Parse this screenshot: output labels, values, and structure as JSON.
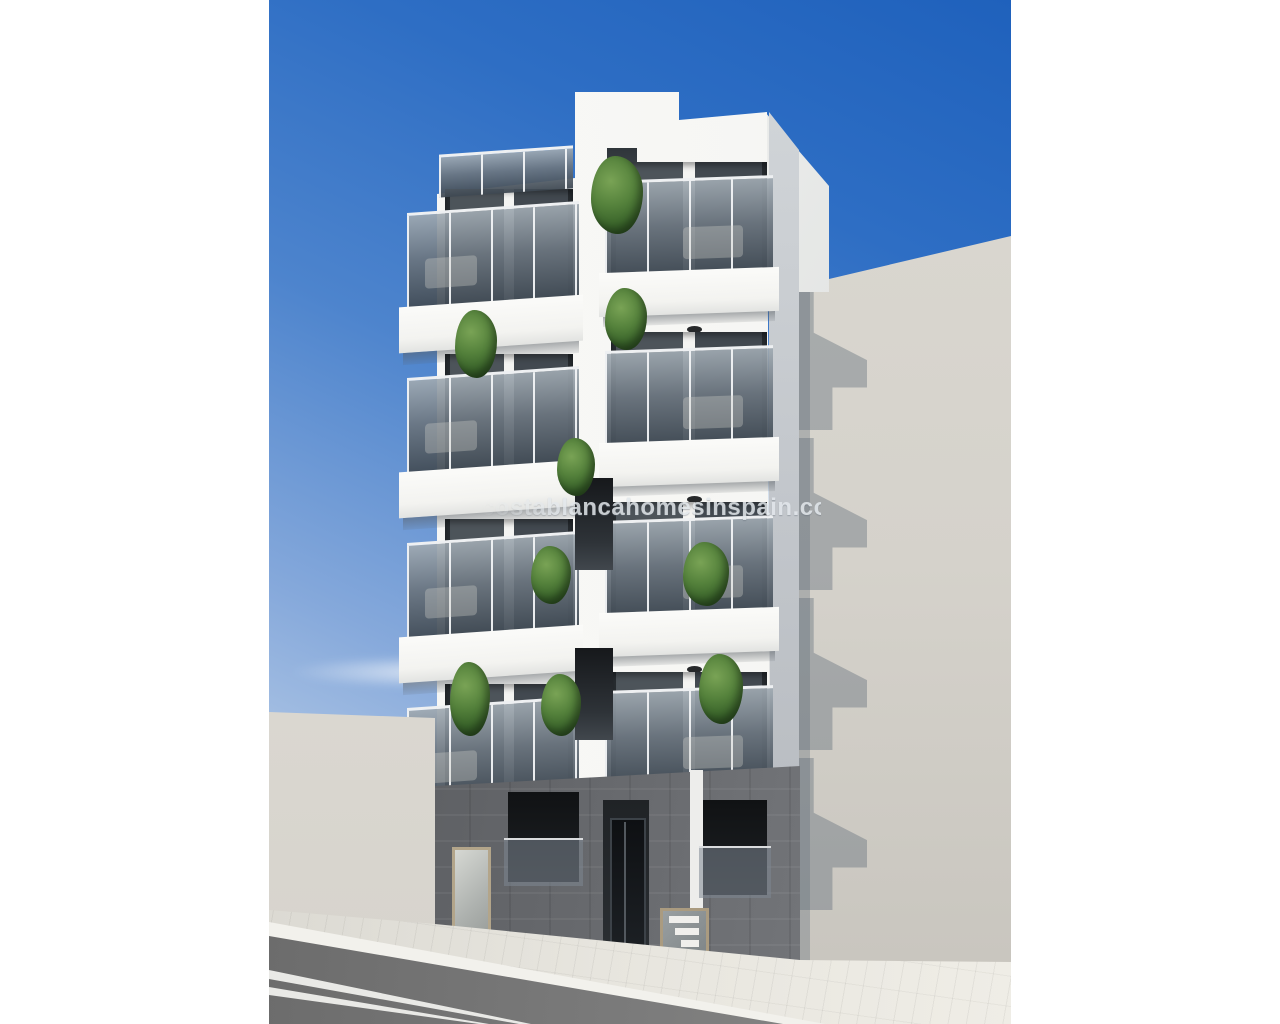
{
  "subject": "new-build white apartment block render, blue sky, street view",
  "watermark": {
    "text": "costablancahomesinspain.com"
  },
  "colors": {
    "sky_top": "#2062BD",
    "sky_bottom": "#CEDCEE",
    "facade_white": "#F6F6F4",
    "facade_side_shadow": "#C2C6CB",
    "balcony_glass_top": "#9EA8B0",
    "balcony_glass_bottom": "#46505A",
    "neighbor_wall_right": "#DAD7D0",
    "neighbor_wall_left": "#DEDBD4",
    "ground_cladding": "#64666A",
    "window_dark": "#16181B",
    "road": "#7B7B7B",
    "sidewalk": "#E7E5DE",
    "plant_green": "#4A7233",
    "watermark_grey": "#E3E8EC"
  },
  "scene": {
    "left_floors": [
      {
        "y": 183
      },
      {
        "y": 348
      },
      {
        "y": 513
      },
      {
        "y": 678
      }
    ],
    "right_floors": [
      {
        "y": 158
      },
      {
        "y": 328
      },
      {
        "y": 498
      },
      {
        "y": 668
      }
    ],
    "center_recesses": [
      {
        "x": 306,
        "y": 478,
        "w": 38,
        "h": 92
      },
      {
        "x": 306,
        "y": 648,
        "w": 38,
        "h": 92
      },
      {
        "x": 306,
        "y": 818,
        "w": 38,
        "h": 60
      }
    ],
    "roof_railing": {
      "x": 170,
      "y": 150,
      "w": 134,
      "h": 40
    },
    "shadow_steps": [
      {
        "x": 526,
        "y": 278
      },
      {
        "x": 526,
        "y": 438
      },
      {
        "x": 526,
        "y": 598
      },
      {
        "x": 526,
        "y": 758
      }
    ],
    "plants": [
      {
        "x": 322,
        "y": 156,
        "w": 52,
        "h": 78
      },
      {
        "x": 186,
        "y": 310,
        "w": 42,
        "h": 68
      },
      {
        "x": 336,
        "y": 288,
        "w": 42,
        "h": 62
      },
      {
        "x": 288,
        "y": 438,
        "w": 38,
        "h": 58
      },
      {
        "x": 262,
        "y": 546,
        "w": 40,
        "h": 58
      },
      {
        "x": 414,
        "y": 542,
        "w": 46,
        "h": 64
      },
      {
        "x": 181,
        "y": 662,
        "w": 40,
        "h": 74
      },
      {
        "x": 272,
        "y": 674,
        "w": 40,
        "h": 62
      },
      {
        "x": 430,
        "y": 654,
        "w": 44,
        "h": 70
      },
      {
        "x": 284,
        "y": 806,
        "w": 26,
        "h": 34
      }
    ],
    "stair_steps": [
      {
        "x": 400,
        "y": 916,
        "w": 30,
        "h": 7
      },
      {
        "x": 406,
        "y": 928,
        "w": 24,
        "h": 7
      },
      {
        "x": 412,
        "y": 940,
        "w": 18,
        "h": 7
      }
    ]
  }
}
